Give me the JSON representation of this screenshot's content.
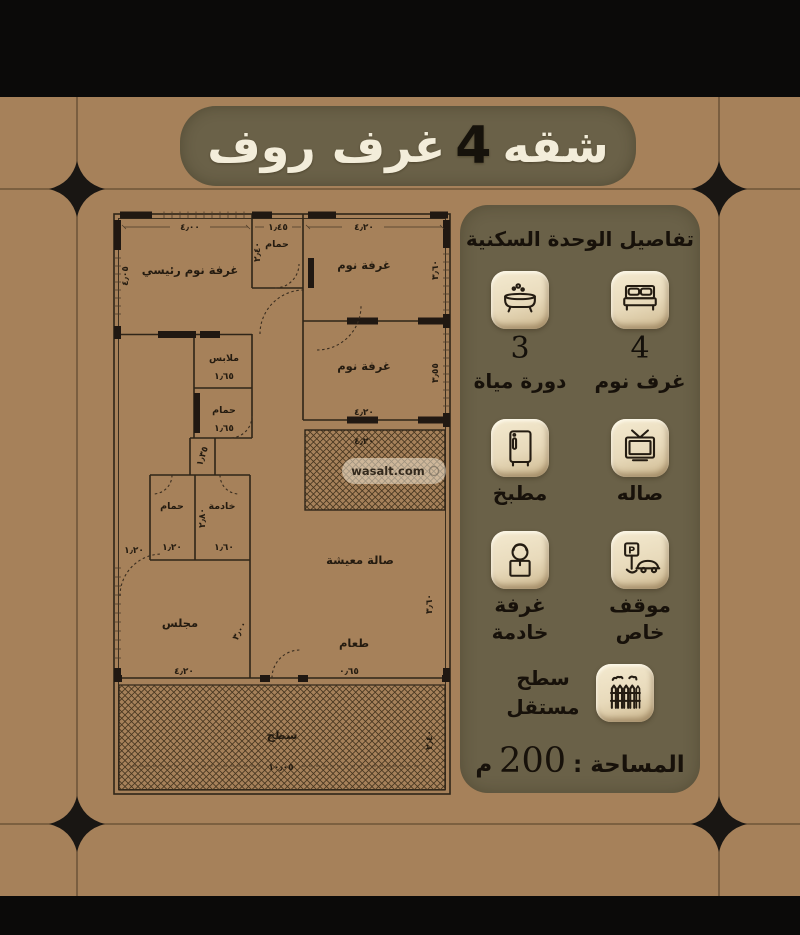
{
  "title": {
    "part_right": "شقه",
    "number": "4",
    "part_left": "غرف روف"
  },
  "panel": {
    "heading": "تفاصيل الوحدة السكنية",
    "parking_letter": "P",
    "features": [
      {
        "id": "bedrooms",
        "count": "4",
        "label": "غرف نوم"
      },
      {
        "id": "bathrooms",
        "count": "3",
        "label": "دورة مياة"
      },
      {
        "id": "hall",
        "label": "صاله"
      },
      {
        "id": "kitchen",
        "label": "مطبخ"
      },
      {
        "id": "private-parking",
        "label_line1": "موقف",
        "label_line2": "خاص"
      },
      {
        "id": "maid-room",
        "label_line1": "غرفة",
        "label_line2": "خادمة"
      }
    ],
    "roof": {
      "label_line1": "سطح",
      "label_line2": "مستقل"
    },
    "area": {
      "label": "المساحة :",
      "value": "200",
      "unit": "م"
    }
  },
  "floorplan": {
    "watermark": "wasalt.com",
    "rooms": [
      "غرفة نوم رئيسي",
      "حمام",
      "غرفة نوم",
      "غرفة نوم",
      "ملابس",
      "حمام",
      "حمام",
      "خادمة",
      "صالة معيشة",
      "مجلس",
      "طعام",
      "سطح"
    ],
    "dims": [
      "٤٫٠٠",
      "١٫٤٥",
      "٤٫٢٠",
      "٤٫٠٥",
      "٢٫٤٠",
      "٣٫٦٠",
      "٣٫٥٥",
      "٤٫٢٠",
      "١٫٦٥",
      "١٫٦٥",
      "١٫٣٥",
      "٢٫٨٠",
      "١٫٢٠",
      "١٫٢٠",
      "١٫٦٠",
      "٣٫٠٠",
      "٤٫٢٠",
      "٠٫٦٥",
      "٣٫٦٠",
      "١٠٫٠٥",
      "٢٫٤٠",
      "٤٫٢٠"
    ]
  },
  "colors": {
    "background": "#a6815a",
    "panel": "#6a6148",
    "tile": "#eaddc1",
    "ink": "#241b10",
    "title_text": "#f3edda",
    "letterbox": "#0b0a09"
  }
}
